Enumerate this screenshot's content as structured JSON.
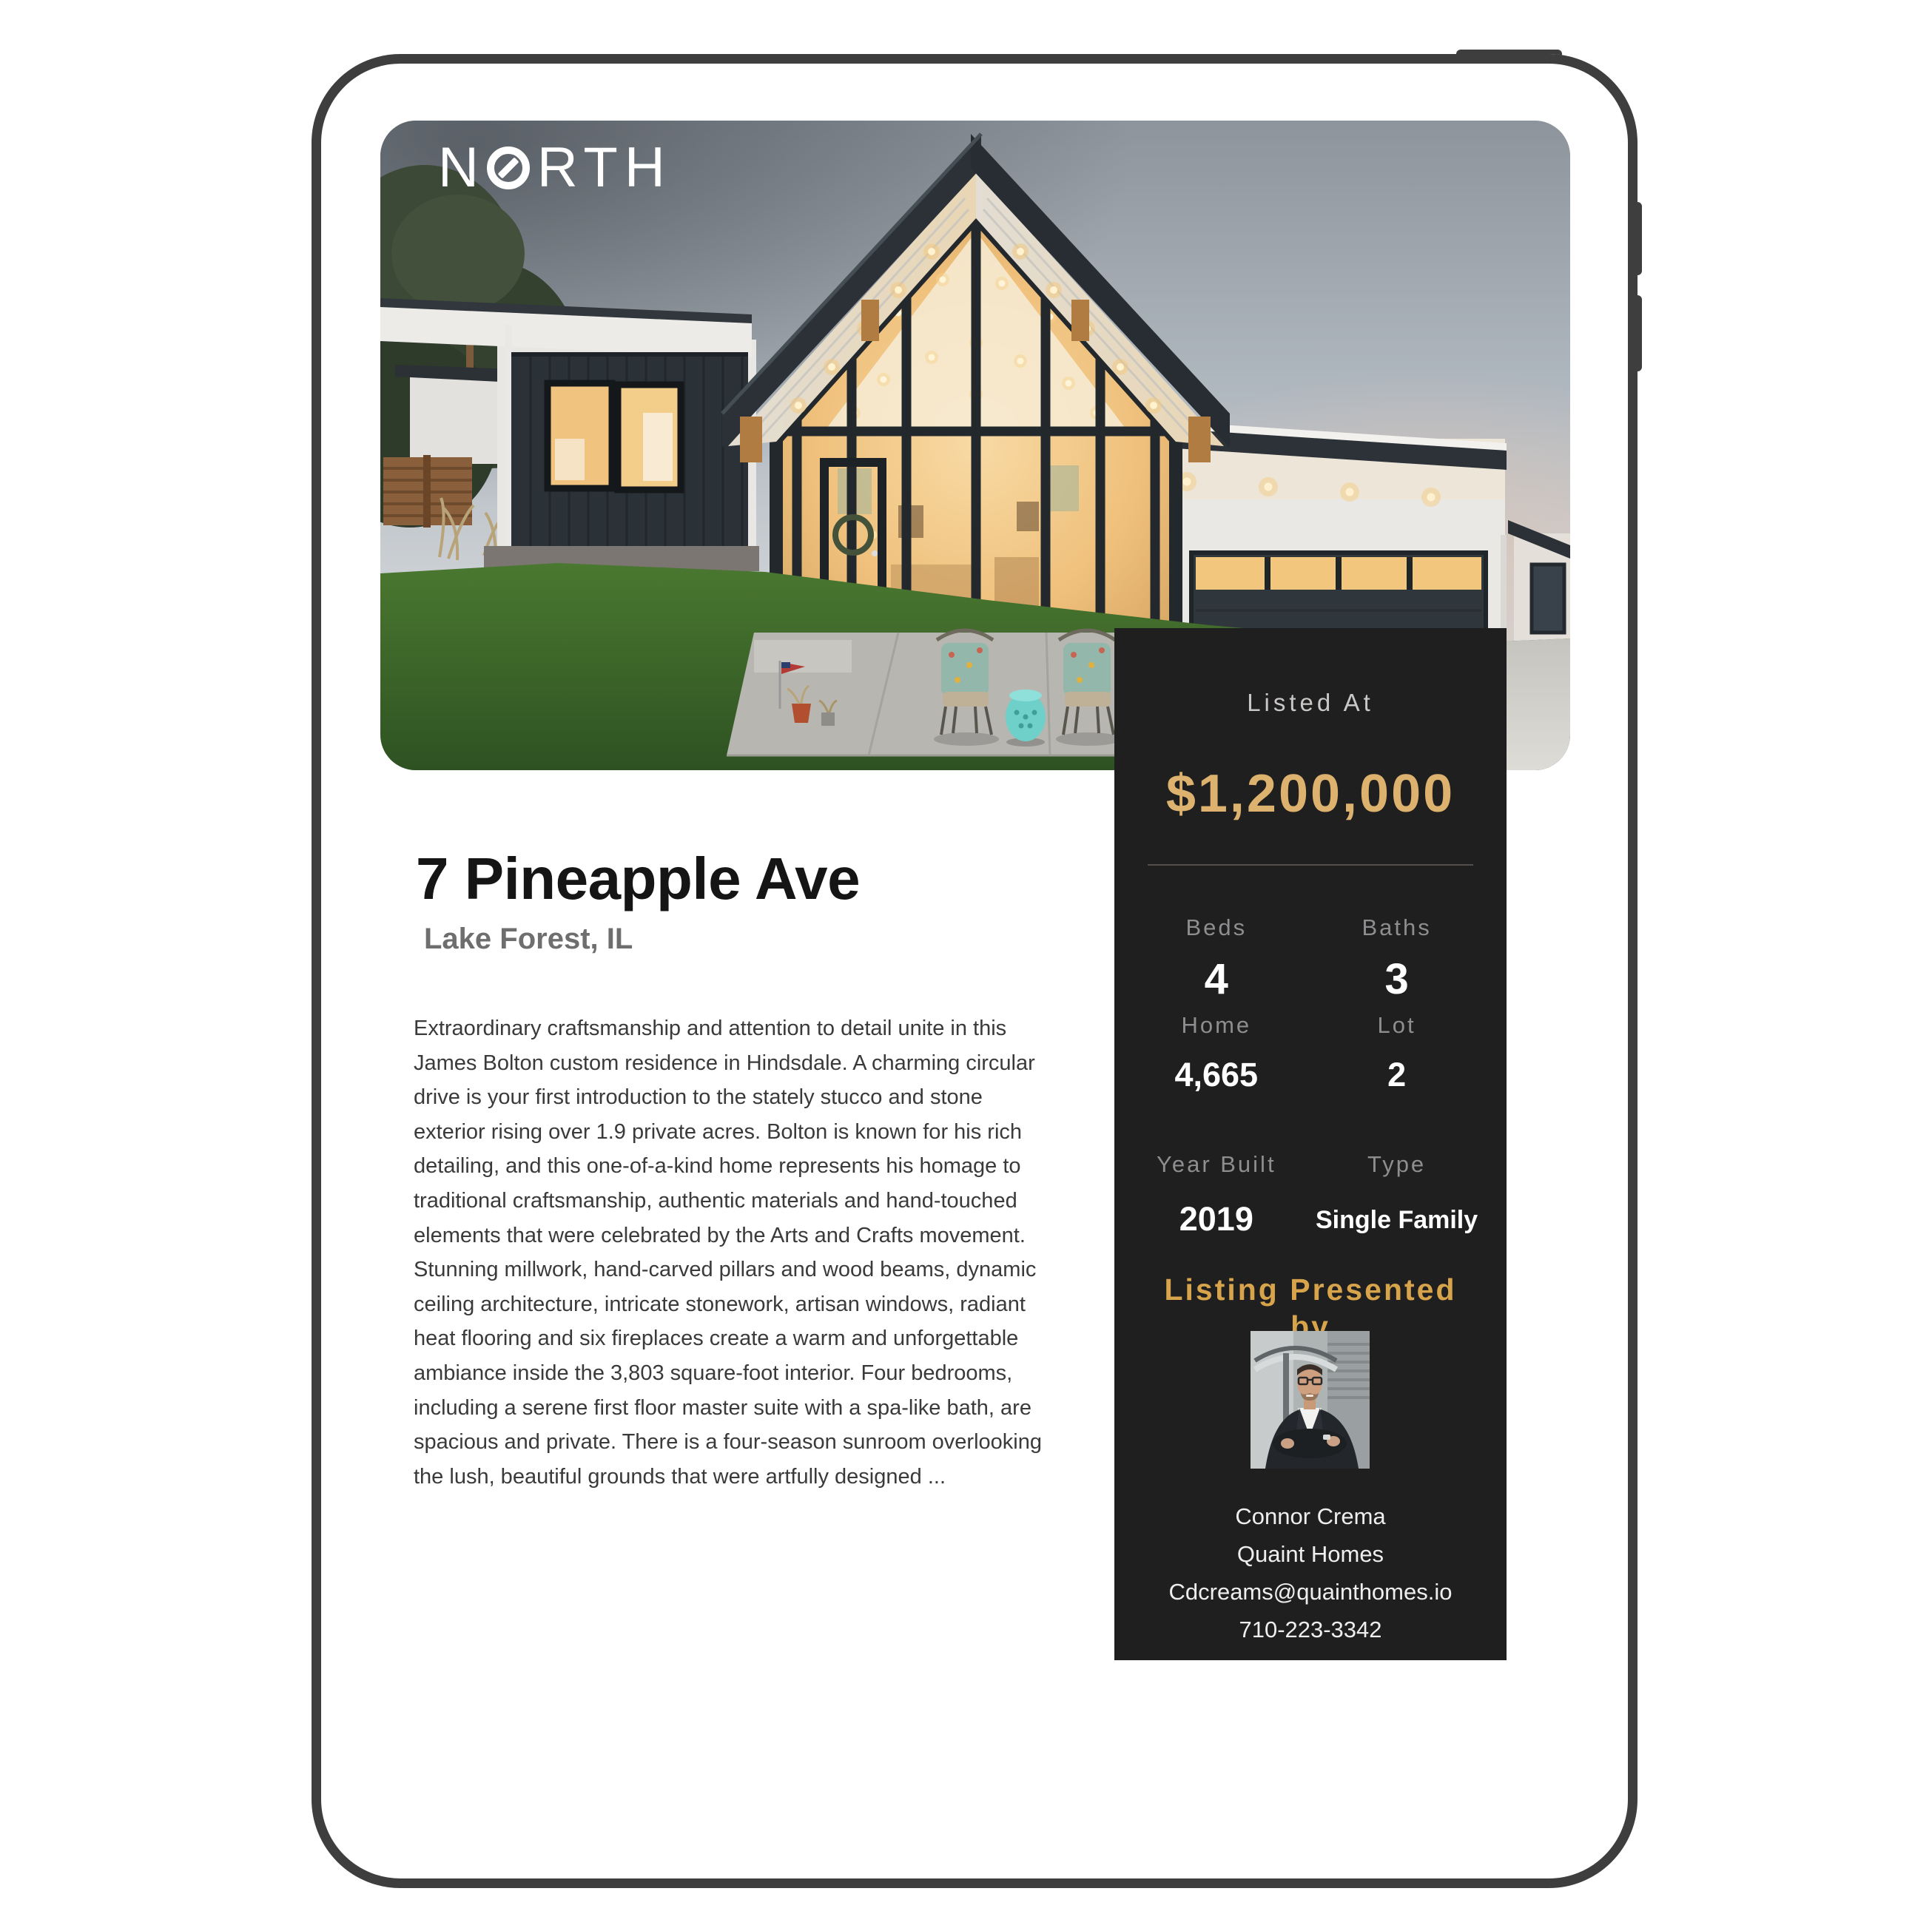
{
  "brand": {
    "prefix": "N",
    "suffix": "RTH",
    "full": "NORTH"
  },
  "listing": {
    "title": "7 Pineapple Ave",
    "location": "Lake Forest, IL",
    "description_lines": [
      "Extraordinary craftsmanship and attention to detail unite in this",
      "James Bolton custom residence in Hindsdale. A charming circular",
      "drive is your first introduction to the stately stucco and stone",
      "exterior rising over 1.9 private acres. Bolton is known for his rich",
      "detailing, and this one-of-a-kind home represents his homage to",
      "traditional craftsmanship, authentic materials and hand-touched",
      "elements that were celebrated by the Arts and Crafts movement.",
      "Stunning millwork, hand-carved pillars and wood beams, dynamic",
      "ceiling architecture, intricate stonework, artisan windows, radiant",
      "heat flooring and six fireplaces create a warm and unforgettable",
      "ambiance inside the 3,803 square-foot interior. Four bedrooms,",
      "including a serene first floor master suite with a spa-like bath, are",
      "spacious and private. There is a four-season sunroom overlooking",
      "the lush, beautiful grounds that were artfully designed ..."
    ]
  },
  "price_card": {
    "listed_at_label": "Listed At",
    "price": "$1,200,000",
    "stats": [
      {
        "label": "Beds",
        "value": "4"
      },
      {
        "label": "Baths",
        "value": "3"
      },
      {
        "label": "Home",
        "value": "4,665"
      },
      {
        "label": "Lot",
        "value": "2"
      },
      {
        "label": "Year Built",
        "value": "2019"
      },
      {
        "label": "Type",
        "value": "Single Family"
      }
    ],
    "presented_by_line1": "Listing Presented",
    "presented_by_line2": "by",
    "agent": {
      "name": "Connor Crema",
      "company": "Quaint Homes",
      "email": "Cdcreams@quainthomes.io",
      "phone": "710-223-3342"
    }
  },
  "colors": {
    "accent_gold": "#DCB26E",
    "heading_gold": "#D7A44C",
    "card_background": "#201F1F",
    "frame": "#3E3E3E"
  }
}
